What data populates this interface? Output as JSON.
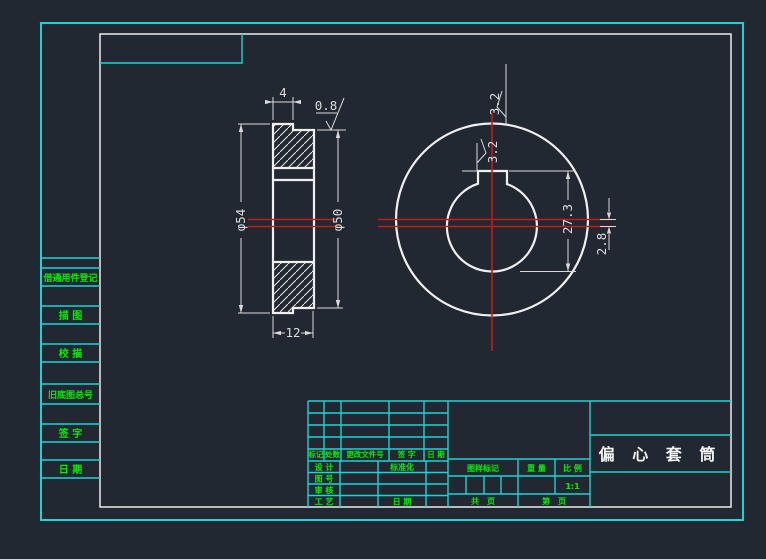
{
  "colors": {
    "background": "#222831",
    "border_cyan": "#1bd4d4",
    "label_green": "#00ef00",
    "line_white": "#ebebeb",
    "centerline_red": "#c61b1b",
    "dimension_gray": "#dcdcdc"
  },
  "side_strip": {
    "items": [
      "借通用件登记",
      "描 图",
      "校 描",
      "旧底图总号",
      "签 字",
      "日 期"
    ]
  },
  "title_block": {
    "revision_cols": [
      "标记",
      "处数",
      "更改文件号",
      "签 字",
      "日 期"
    ],
    "sign_rows": [
      "设 计",
      "图 号",
      "审 核",
      "工 艺"
    ],
    "standardization_label": "标准化",
    "date_label": "日 期",
    "stamp_label": "图样标记",
    "weight_label": "重 量",
    "scale_label": "比 例",
    "scale_value": "1:1",
    "sheet_total_label": "共　页",
    "sheet_no_label": "第　页",
    "part_name": "偏 心 套 筒"
  },
  "drawing": {
    "section_view": {
      "collar_width_dim": "4",
      "roughness_face": "0.8",
      "outer_dia_dim": "φ54",
      "step_dia_dim": "φ50",
      "width_dim": "12"
    },
    "front_view": {
      "roughness_outer": "3.2",
      "roughness_keyway": "3.2",
      "keyway_dim": "27.3",
      "eccentricity_dim": "2.8"
    }
  }
}
